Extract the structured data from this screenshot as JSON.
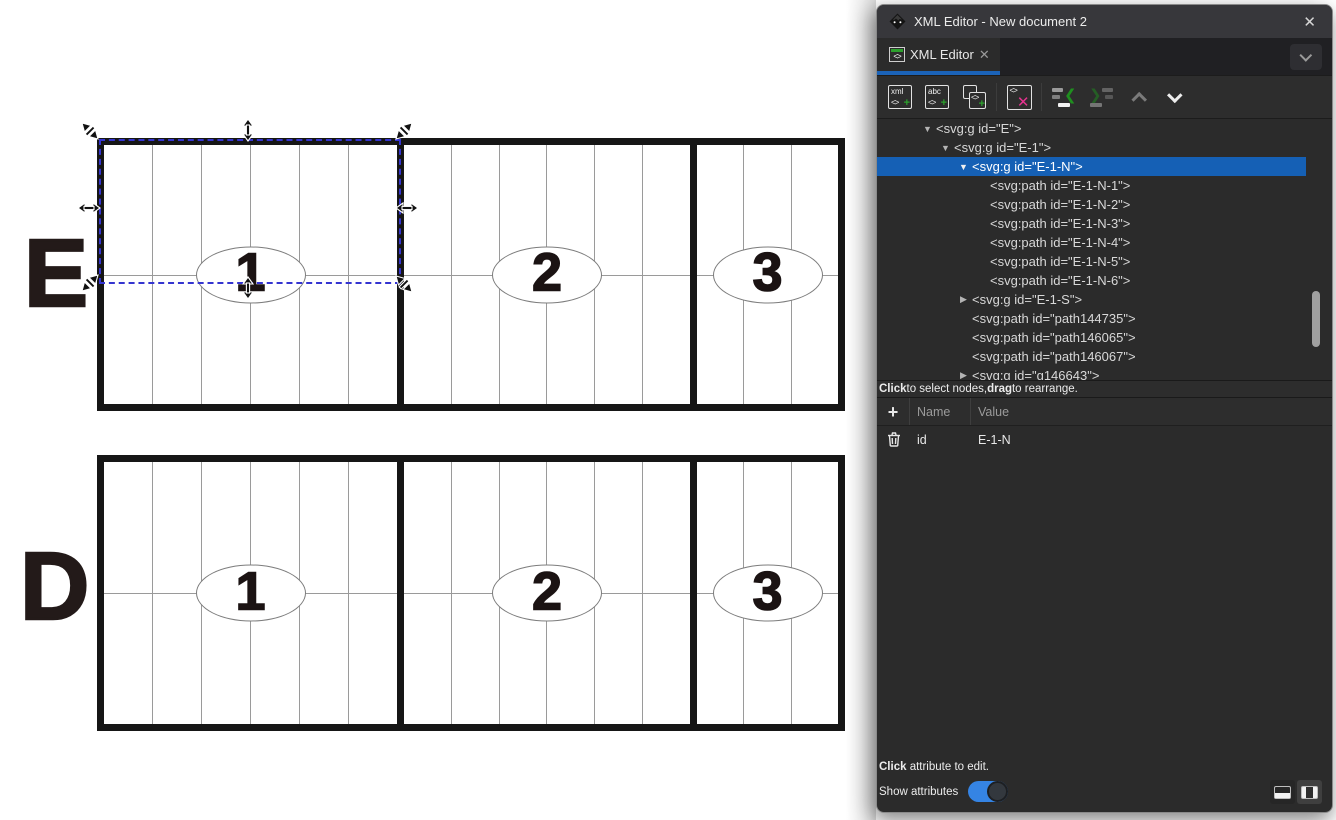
{
  "window": {
    "title": "XML Editor - New document 2",
    "close_glyph": "✕"
  },
  "tab": {
    "label": "XML Editor",
    "close_glyph": "✕",
    "icon_glyph": "<>"
  },
  "toolbar": {
    "new_element": {
      "line1": "xml",
      "line2": "<>",
      "plus": "+"
    },
    "new_text": {
      "line1": "abc",
      "line2": "<>",
      "plus": "+"
    },
    "duplicate": {
      "glyph": "<>",
      "plus": "+"
    },
    "delete": {
      "glyph": "<>",
      "x": "✕"
    },
    "unindent_chevron": "❮",
    "indent_chevron": "❯"
  },
  "tree": {
    "rows": [
      {
        "label": "<svg:g id=\"E\">",
        "level": 1,
        "arrow": "open",
        "selected": false
      },
      {
        "label": "<svg:g id=\"E-1\">",
        "level": 2,
        "arrow": "open",
        "selected": false
      },
      {
        "label": "<svg:g id=\"E-1-N\">",
        "level": 3,
        "arrow": "open",
        "selected": true
      },
      {
        "label": "<svg:path id=\"E-1-N-1\">",
        "level": 4,
        "arrow": "none",
        "selected": false
      },
      {
        "label": "<svg:path id=\"E-1-N-2\">",
        "level": 4,
        "arrow": "none",
        "selected": false
      },
      {
        "label": "<svg:path id=\"E-1-N-3\">",
        "level": 4,
        "arrow": "none",
        "selected": false
      },
      {
        "label": "<svg:path id=\"E-1-N-4\">",
        "level": 4,
        "arrow": "none",
        "selected": false
      },
      {
        "label": "<svg:path id=\"E-1-N-5\">",
        "level": 4,
        "arrow": "none",
        "selected": false
      },
      {
        "label": "<svg:path id=\"E-1-N-6\">",
        "level": 4,
        "arrow": "none",
        "selected": false
      },
      {
        "label": "<svg:g id=\"E-1-S\">",
        "level": 3,
        "arrow": "closed",
        "selected": false
      },
      {
        "label": "<svg:path id=\"path144735\">",
        "level": 3,
        "arrow": "none",
        "selected": false
      },
      {
        "label": "<svg:path id=\"path146065\">",
        "level": 3,
        "arrow": "none",
        "selected": false
      },
      {
        "label": "<svg:path id=\"path146067\">",
        "level": 3,
        "arrow": "none",
        "selected": false
      },
      {
        "label": "<svg:g id=\"g146643\">",
        "level": 3,
        "arrow": "closed",
        "selected": false
      }
    ],
    "hint_segments": [
      {
        "t": "Click",
        "b": true
      },
      {
        "t": " to select nodes, ",
        "b": false
      },
      {
        "t": "drag",
        "b": true
      },
      {
        "t": " to rearrange.",
        "b": false
      }
    ]
  },
  "attributes": {
    "plus_glyph": "+",
    "name_header": "Name",
    "value_header": "Value",
    "rows": [
      {
        "name": "id",
        "value": "E-1-N"
      }
    ],
    "hint_segments": [
      {
        "t": "Click",
        "b": true
      },
      {
        "t": " attribute to edit.",
        "b": false
      }
    ],
    "show_label": "Show attributes",
    "toggle_on": true
  },
  "canvas": {
    "figures": [
      {
        "letter": "E",
        "sections": [
          {
            "label": "1"
          },
          {
            "label": "2"
          },
          {
            "label": "3"
          }
        ]
      },
      {
        "letter": "D",
        "sections": [
          {
            "label": "1"
          },
          {
            "label": "2"
          },
          {
            "label": "3"
          }
        ]
      }
    ],
    "selection": {
      "target_id": "E-1-N"
    }
  },
  "colors": {
    "selected_row_blue": "#1560b5",
    "tab_underline_blue": "#1b63b8",
    "toggle_blue": "#3584e4",
    "icon_green": "#2da12d",
    "icon_pink": "#e5338f",
    "selection_dash_blue": "#3434d0"
  }
}
